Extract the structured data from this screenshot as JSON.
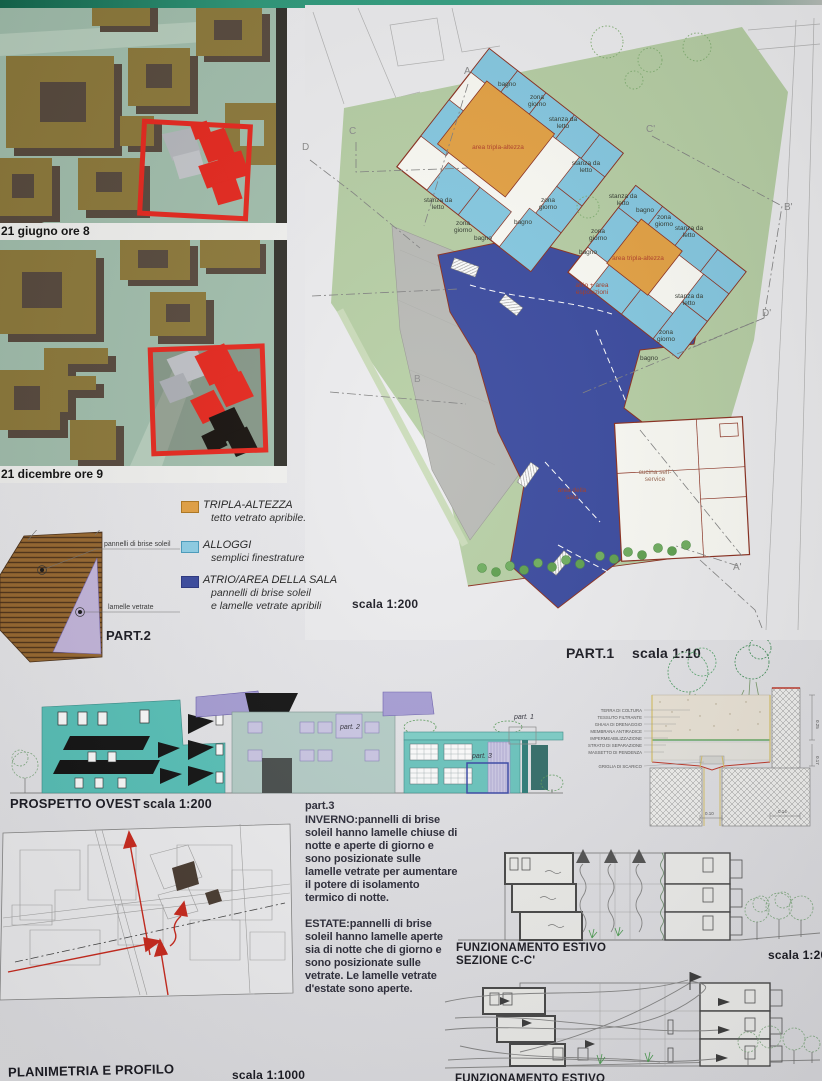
{
  "palette": {
    "accent_red": "#e8281e",
    "wall_red": "#8b2f1f",
    "site_green": "#b7cfa5",
    "teal_elevation": "#5ec4bd",
    "purple_roof": "#a89fd6",
    "paper": "#e9e9ec",
    "atrio_blue": "#3a4a9f",
    "alloggi_blue": "#85c9e2",
    "tripla_orange": "#e5a243"
  },
  "shadow_studies": {
    "label_june": "21 giugno ore 8",
    "label_december": "21 dicembre ore 9"
  },
  "site_plan": {
    "scale_label": "scala 1:200",
    "rooms": [
      "bagno",
      "zona giorno",
      "stanza da letto",
      "stanza da letto",
      "area tripla-altezza",
      "stanza da letto",
      "zona giorno",
      "bagno",
      "zona giorno",
      "bagno",
      "stanza da letto",
      "bagno",
      "zona giorno",
      "stanza da letto",
      "zona giorno",
      "bagno",
      "area tripla-altezza",
      "stanza da letto",
      "zona giorno",
      "bagno",
      "atrio + area esposizioni",
      "area della sala",
      "cucina self-service"
    ],
    "section_letters": [
      "A",
      "C",
      "D",
      "C'",
      "B'",
      "D'",
      "B",
      "A'"
    ]
  },
  "legend": {
    "items": [
      {
        "title": "TRIPLA-ALTEZZA",
        "desc": "tetto vetrato apribile."
      },
      {
        "title": "ALLOGGI",
        "desc": "semplici finestrature"
      },
      {
        "title": "ATRIO/AREA DELLA SALA",
        "desc": "pannelli di brise soleil",
        "desc2": "e lamelle vetrate apribili"
      }
    ],
    "scale_label": "scala 1:200"
  },
  "part2": {
    "title": "PART.2",
    "callout_top": "pannelli di brise soleil",
    "callout_bottom": "lamelle vetrate"
  },
  "part1": {
    "title": "PART.1",
    "scale": "scala 1:10",
    "layers": [
      "TERRA DI COLTURA",
      "TESSUTO FILTRANTE",
      "GHIAIA DI DRENAGGIO",
      "MEMBRANA ANTIRADICE",
      "IMPERMEABILIZZAZIONE",
      "STRATO DI SEPARAZIONE",
      "MASSETTO DI PENDENZA",
      "GRIGLIA DI SCARICO"
    ],
    "dims": {
      "bottom_left": "0.10",
      "bottom_right": "0.14",
      "right_top": "0.25",
      "right_bottom": "0.17"
    }
  },
  "elevation": {
    "title": "PROSPETTO OVEST",
    "scale": "scala 1:200",
    "callout_part1": "part. 1",
    "callout_part2": "part. 2",
    "callout_part3": "part. 3"
  },
  "part3_notes": {
    "title": "part.3",
    "winter": "INVERNO:pannelli di brise soleil hanno lamelle chiuse di notte e aperte di giorno e sono posizionate sulle lamelle vetrate per aumentare il potere di isolamento termico di notte.",
    "summer": "ESTATE:pannelli di brise soleil hanno lamelle aperte sia di notte che di giorno e sono posizionate sulle vetrate. Le lamelle vetrate d'estate sono aperte."
  },
  "section_cc": {
    "title": "FUNZIONAMENTO ESTIVO",
    "subtitle": "SEZIONE C-C'",
    "scale": "scala 1:200"
  },
  "section_bottom": {
    "title": "FUNZIONAMENTO ESTIVO"
  },
  "planimetria": {
    "title": "PLANIMETRIA E PROFILO",
    "scale": "scala 1:1000"
  }
}
